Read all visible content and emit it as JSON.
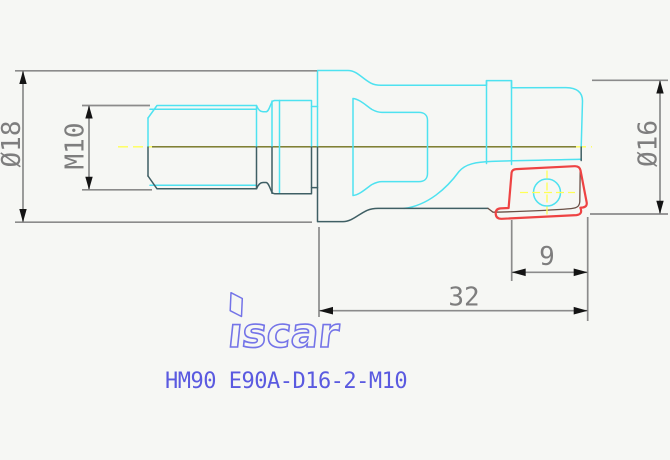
{
  "drawing": {
    "part_number": "HM90 E90A-D16-2-M10",
    "brand": "iscar",
    "logo_glyphs": "ıscar"
  },
  "dimensions": {
    "shank_diameter": "Ø18",
    "thread_size": "M10",
    "cutting_diameter": "Ø16",
    "insert_edge_length": "9",
    "reach_length": "32"
  },
  "colors": {
    "background": "#f6f7f4",
    "outline_top": "#4ee2f0",
    "outline_bottom": "#3f5f64",
    "insert_outline": "#ee4343",
    "centerline_solid": "#6f6f18",
    "centerline_dash": "#ffff55",
    "crosshair": "#ffff55",
    "dimension_lines": "#8b8b8b",
    "dimension_text": "#7e7e7e",
    "part_number_text": "#5a5ae0",
    "logo": "#7474e8"
  }
}
